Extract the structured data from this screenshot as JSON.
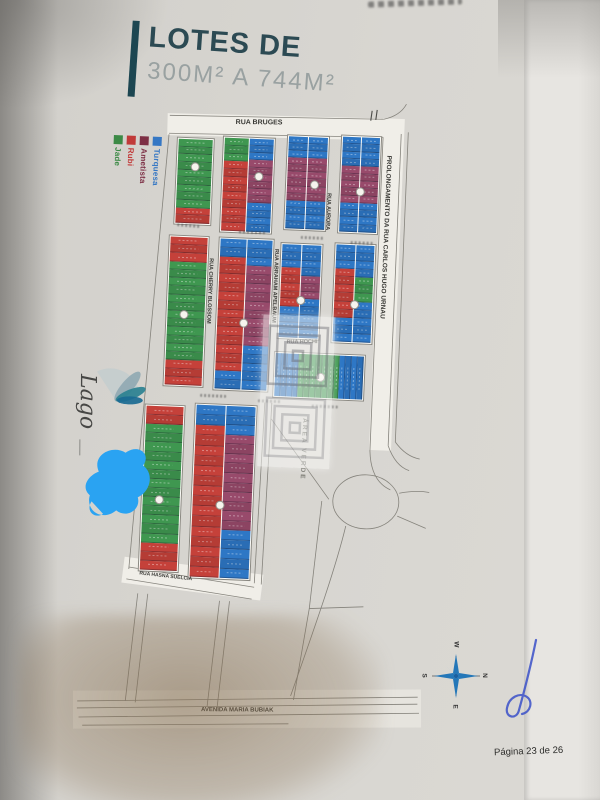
{
  "page": {
    "title_line1": "LOTES DE",
    "title_line2": "300M² A 744M²",
    "page_indicator": "Página 23 de 26",
    "logo_text": "Lago"
  },
  "legend": {
    "items": [
      {
        "label": "Turquesa",
        "color": "#3577c4"
      },
      {
        "label": "Ametista",
        "color": "#7d2f45"
      },
      {
        "label": "Rubi",
        "color": "#c13a39"
      },
      {
        "label": "Jade",
        "color": "#3c8a46"
      }
    ]
  },
  "compass": {
    "north": "N",
    "east": "E",
    "south": "S",
    "west": "W",
    "note": "rotated 90deg clockwise, north points right"
  },
  "map": {
    "lot_colors": {
      "turquesa": "#2e77c5",
      "ametista": "#984a6b",
      "rubi": "#c5413a",
      "jade": "#3f9750"
    },
    "streets": [
      {
        "name": "RUA BRUGES",
        "x": 224,
        "y": 122,
        "rot": -2,
        "vertical": false,
        "size": 7
      },
      {
        "name": "PROLONGAMENTO DA RUA CARLOS HUGO URNAU",
        "x": 375,
        "y": 152,
        "rot": 0,
        "vertical": true,
        "size": 6.5
      },
      {
        "name": "RUA AURORA",
        "x": 317,
        "y": 192,
        "rot": 0,
        "vertical": true,
        "size": 5.5
      },
      {
        "name": "RUA CHERRY BLOSSOM",
        "x": 202,
        "y": 262,
        "rot": 0,
        "vertical": true,
        "size": 5.5
      },
      {
        "name": "RUA ABRAHAM APELBAUM",
        "x": 267,
        "y": 250,
        "rot": 0,
        "vertical": true,
        "size": 5.5
      },
      {
        "name": "RUA HOCHI",
        "x": 284,
        "y": 340,
        "rot": -3,
        "vertical": false,
        "size": 5.5
      },
      {
        "name": "ÁREA VERDE",
        "x": 302,
        "y": 418,
        "rot": 0,
        "vertical": true,
        "size": 6.5,
        "muted": true
      },
      {
        "name": "RUA HASNA SUELCIA",
        "x": 147,
        "y": 577,
        "rot": 4,
        "vertical": false,
        "size": 5
      },
      {
        "name": "AVENIDA MARIA BUBIAK",
        "x": 214,
        "y": 711,
        "rot": -2,
        "vertical": false,
        "size": 6
      }
    ],
    "blocks": [
      {
        "id": "q1",
        "x": 166,
        "y": 142,
        "w": 38,
        "h": 88,
        "badge": [
          18,
          28
        ],
        "cols": [
          {
            "runs": [
              [
                "jade",
                9
              ],
              [
                "rubi",
                2
              ]
            ]
          }
        ]
      },
      {
        "id": "q2",
        "x": 212,
        "y": 139,
        "w": 53,
        "h": 97,
        "badge": [
          36,
          38
        ],
        "cols": [
          {
            "runs": [
              [
                "jade",
                3
              ],
              [
                "rubi",
                9
              ]
            ]
          },
          {
            "runs": [
              [
                "turquesa",
                3
              ],
              [
                "ametista",
                6
              ],
              [
                "turquesa",
                4
              ]
            ]
          }
        ]
      },
      {
        "id": "q3",
        "x": 276,
        "y": 135,
        "w": 43,
        "h": 96,
        "badge": [
          28,
          48
        ],
        "cols": [
          {
            "runs": [
              [
                "turquesa",
                3
              ],
              [
                "ametista",
                6
              ],
              [
                "turquesa",
                4
              ]
            ]
          },
          {
            "runs": [
              [
                "turquesa",
                3
              ],
              [
                "ametista",
                6
              ],
              [
                "turquesa",
                4
              ]
            ]
          }
        ]
      },
      {
        "id": "q4",
        "x": 330,
        "y": 133,
        "w": 41,
        "h": 99,
        "badge": [
          20,
          55
        ],
        "cols": [
          {
            "runs": [
              [
                "turquesa",
                4
              ],
              [
                "ametista",
                5
              ],
              [
                "turquesa",
                4
              ]
            ]
          },
          {
            "runs": [
              [
                "turquesa",
                4
              ],
              [
                "ametista",
                5
              ],
              [
                "turquesa",
                4
              ]
            ]
          }
        ]
      },
      {
        "id": "q5",
        "x": 162,
        "y": 240,
        "w": 41,
        "h": 152,
        "badge": [
          17,
          78
        ],
        "cols": [
          {
            "runs": [
              [
                "rubi",
                3
              ],
              [
                "jade",
                12
              ],
              [
                "rubi",
                3
              ]
            ]
          }
        ]
      },
      {
        "id": "q6",
        "x": 212,
        "y": 240,
        "w": 56,
        "h": 154,
        "badge": [
          27,
          84
        ],
        "cols": [
          {
            "runs": [
              [
                "turquesa",
                2
              ],
              [
                "rubi",
                13
              ],
              [
                "turquesa",
                2
              ]
            ]
          },
          {
            "runs": [
              [
                "turquesa",
                3
              ],
              [
                "ametista",
                9
              ],
              [
                "turquesa",
                5
              ]
            ]
          }
        ]
      },
      {
        "id": "q7",
        "x": 274,
        "y": 243,
        "w": 43,
        "h": 97,
        "badge": [
          21,
          56
        ],
        "cols": [
          {
            "runs": [
              [
                "turquesa",
                3
              ],
              [
                "rubi",
                5
              ],
              [
                "turquesa",
                4
              ]
            ]
          },
          {
            "runs": [
              [
                "turquesa",
                4
              ],
              [
                "ametista",
                3
              ],
              [
                "turquesa",
                5
              ]
            ]
          }
        ]
      },
      {
        "id": "q8",
        "x": 328,
        "y": 241,
        "w": 42,
        "h": 101,
        "badge": [
          21,
          60
        ],
        "cols": [
          {
            "runs": [
              [
                "turquesa",
                3
              ],
              [
                "rubi",
                6
              ],
              [
                "turquesa",
                3
              ]
            ]
          },
          {
            "runs": [
              [
                "turquesa",
                4
              ],
              [
                "jade",
                3
              ],
              [
                "turquesa",
                5
              ]
            ]
          }
        ]
      },
      {
        "id": "q9",
        "x": 272,
        "y": 352,
        "w": 92,
        "h": 47,
        "badge": [
          46,
          23
        ],
        "cols": [
          {
            "dir": "h",
            "runs": [
              [
                "turquesa",
                4
              ],
              [
                "jade",
                7
              ],
              [
                "turquesa",
                4
              ]
            ]
          }
        ]
      },
      {
        "id": "q10",
        "x": 145,
        "y": 410,
        "w": 41,
        "h": 168,
        "badge": [
          17,
          94
        ],
        "cols": [
          {
            "runs": [
              [
                "rubi",
                2
              ],
              [
                "jade",
                13
              ],
              [
                "rubi",
                3
              ]
            ]
          }
        ]
      },
      {
        "id": "q11",
        "x": 195,
        "y": 407,
        "w": 63,
        "h": 176,
        "badge": [
          28,
          100
        ],
        "cols": [
          {
            "runs": [
              [
                "turquesa",
                2
              ],
              [
                "rubi",
                15
              ]
            ]
          },
          {
            "runs": [
              [
                "turquesa",
                3
              ],
              [
                "ametista",
                10
              ],
              [
                "turquesa",
                5
              ]
            ]
          }
        ]
      }
    ]
  }
}
